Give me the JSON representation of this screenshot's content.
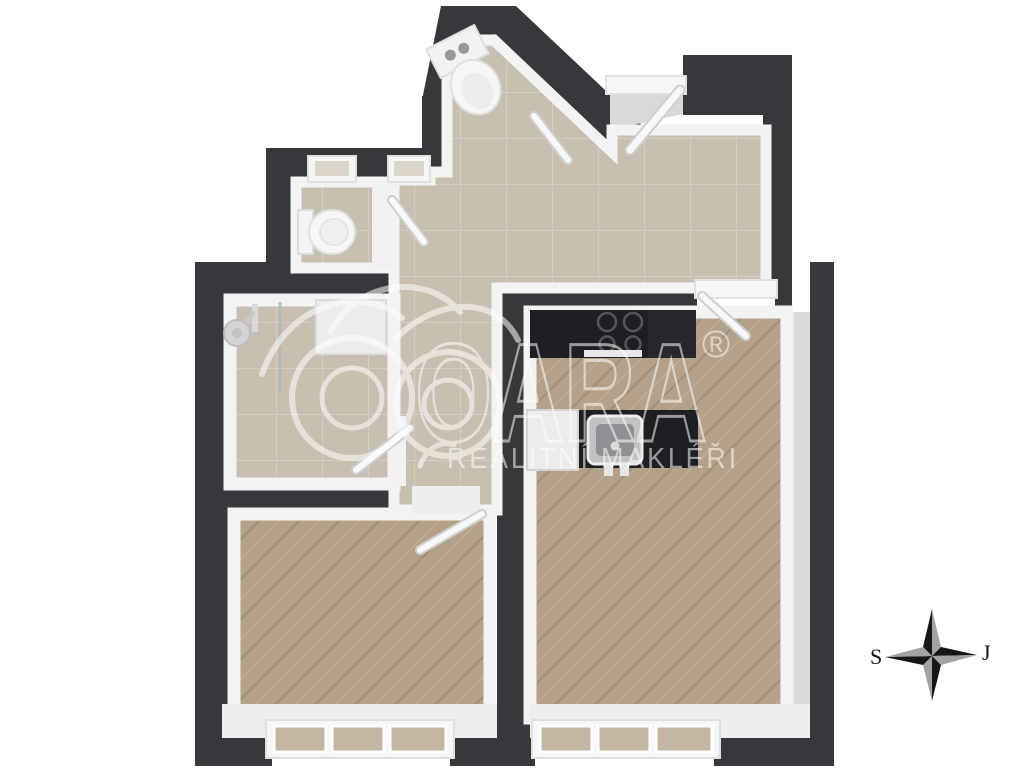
{
  "image": {
    "type": "3d-floor-plan-top-view",
    "background_color": "#ffffff"
  },
  "watermark": {
    "brand": "OARA",
    "registered_symbol": "®",
    "subtitle": "REALITNÍ MAKLÉŘI",
    "color": "#ffffff",
    "opacity": 0.55
  },
  "compass": {
    "left_label": "S",
    "right_label": "J",
    "dark_color": "#161616",
    "light_color": "#a3a3a3"
  },
  "palette": {
    "wall_dark": "#37373c",
    "wall_face": "#f3f3f3",
    "wall_face_shade": "#d9d9d9",
    "tile_floor": "#c8bfb1",
    "tile_grout": "#d6cec2",
    "wood_floor": "#b5a189",
    "wood_grain_dark": "#a28f77",
    "wood_grain_light": "#c2ae96",
    "kitchen_counter": "#1f1f23",
    "fixture_white": "#f2f2f2",
    "glass": "#c3b6a2"
  },
  "rooms": [
    "entry-hall",
    "corridor",
    "wc-top",
    "wc-left",
    "bathroom",
    "bedroom",
    "living-room-with-kitchen"
  ],
  "fixtures": [
    "entrance-door",
    "toilet",
    "toilet",
    "washbasin",
    "shower",
    "shower-glass-panel",
    "interior-door",
    "interior-door",
    "interior-door",
    "interior-door",
    "cooktop",
    "kitchen-counter",
    "kitchen-island",
    "kitchen-sink",
    "dishwasher",
    "window",
    "window",
    "small-window",
    "small-window"
  ]
}
